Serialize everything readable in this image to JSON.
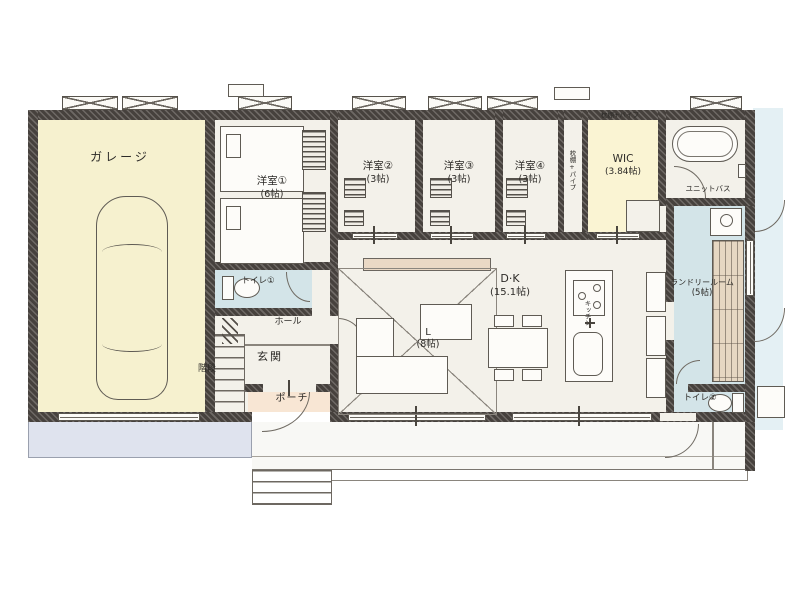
{
  "plan_type": "floor-plan",
  "rooms": {
    "garage": {
      "name": "ガレージ"
    },
    "bedroom1": {
      "name": "洋室①",
      "area": "(6帖)"
    },
    "bedroom2": {
      "name": "洋室②",
      "area": "(3帖)"
    },
    "bedroom3": {
      "name": "洋室③",
      "area": "(3帖)"
    },
    "bedroom4": {
      "name": "洋室④",
      "area": "(3帖)"
    },
    "wic": {
      "name": "WIC",
      "area": "(3.84帖)"
    },
    "unit_bath": {
      "name": "ユニットバス"
    },
    "laundry": {
      "name": "ランドリールーム",
      "area": "(5帖)"
    },
    "dk": {
      "name": "D·K",
      "area": "(15.1帖)"
    },
    "living": {
      "name": "L",
      "area": "(8帖)"
    },
    "kitchen": {
      "name": "キッチン"
    },
    "toilet1": {
      "name": "トイレ①"
    },
    "toilet2": {
      "name": "トイレ②"
    },
    "hall": {
      "name": "ホール"
    },
    "entrance": {
      "name": "玄関"
    },
    "porch": {
      "name": "ポーチ"
    },
    "stairs": {
      "name": "階段"
    }
  },
  "notes": {
    "shelf_pipe": "枕棚+パイプ"
  },
  "colors": {
    "wall": "#46413d",
    "floor": "#f3f1ea",
    "garage_floor": "#f6f1cf",
    "wic_floor": "#faf4d3",
    "wet_area_floor": "#d3e4e8",
    "porch_floor": "#f8e6d4",
    "driveway": "#dfe3ee",
    "deck": "#f8f8f5",
    "tv_board": "#ead9c5"
  }
}
